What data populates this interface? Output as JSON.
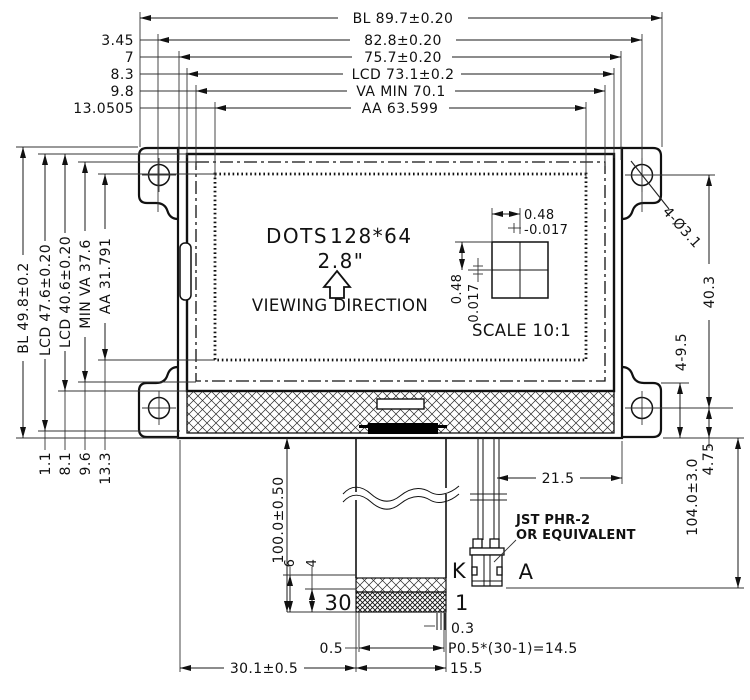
{
  "display": {
    "dots_label": "DOTS",
    "dots_value": "128*64",
    "size": "2.8\"",
    "viewing_direction": "VIEWING DIRECTION"
  },
  "pixel_detail": {
    "width": "0.48",
    "width_tol": "-0.017",
    "height": "0.48",
    "height_tol": "0.017",
    "caption": "SCALE 10:1"
  },
  "dims_top": [
    {
      "label": "BL 89.7±0.20"
    },
    {
      "label": "82.8±0.20",
      "offset": "3.45"
    },
    {
      "label": "75.7±0.20",
      "offset": "7"
    },
    {
      "label": "LCD 73.1±0.2",
      "offset": "8.3"
    },
    {
      "label": "VA MIN 70.1",
      "offset": "9.8"
    },
    {
      "label": "AA 63.599",
      "offset": "13.0505"
    }
  ],
  "dims_left": [
    {
      "label": "BL 49.8±0.2"
    },
    {
      "label": "LCD 47.6±0.20",
      "offset": "1.1"
    },
    {
      "label": "LCD 40.6±0.20",
      "offset": "8.1"
    },
    {
      "label": "MIN VA 37.6",
      "offset": "9.6"
    },
    {
      "label": "AA 31.791",
      "offset": "13.3"
    }
  ],
  "dims_right": {
    "mounting_holes": "4-Ø3.1",
    "hole_spacing": "40.3",
    "tab_height": "4-9.5",
    "hole_to_edge": "4.75",
    "connector_drop": "104.0±3.0",
    "wire_inset": "21.5"
  },
  "connector": {
    "type_line1": "JST PHR-2",
    "type_line2": "OR EQUIVALENT",
    "pin_k": "K",
    "pin_a": "A"
  },
  "fpc": {
    "length": "100.0±0.50",
    "stiffener_height": "6",
    "contact_height": "4",
    "pin_first": "30",
    "pin_last": "1",
    "pin_width": "0.3",
    "edge_margin": "0.5",
    "pitch": "P0.5*(30-1)=14.5",
    "tail_width": "15.5",
    "tail_offset": "30.1±0.5"
  }
}
